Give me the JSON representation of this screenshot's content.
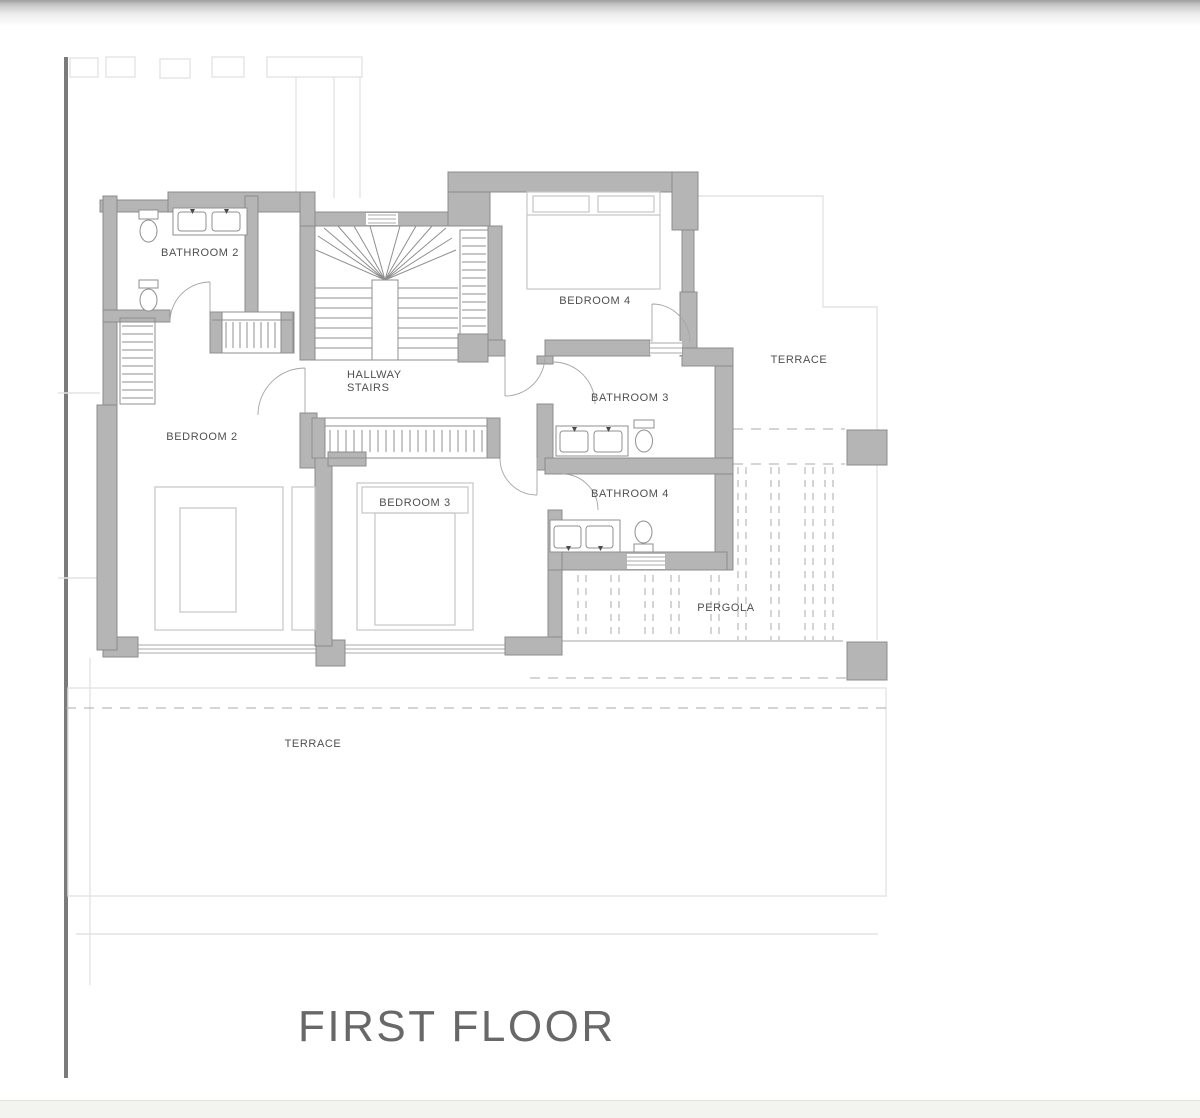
{
  "page": {
    "background": "#ffffff",
    "top_bar_gradient_top": "#9e9e9e",
    "bottom_bar_color": "#f3f3f0",
    "left_divider_color": "#7b7b7b"
  },
  "plan": {
    "title": "FIRST FLOOR",
    "title_color": "#686868",
    "wall_color": "#b5b5b5",
    "wall_edge_color": "#8c8c8c",
    "line_color": "#8f8f8f",
    "furniture_line_color": "#c6c6c6",
    "faint_line_color": "#e3e3e3",
    "dashed_line_color": "#ababab",
    "label_color": "#4f4f4f",
    "labels": [
      {
        "id": "bathroom-2",
        "text": "BATHROOM 2"
      },
      {
        "id": "hallway",
        "text": "HALLWAY"
      },
      {
        "id": "stairs",
        "text": "STAIRS"
      },
      {
        "id": "bedroom-2",
        "text": "BEDROOM 2"
      },
      {
        "id": "bedroom-4",
        "text": "BEDROOM 4"
      },
      {
        "id": "bathroom-3",
        "text": "BATHROOM 3"
      },
      {
        "id": "bathroom-4",
        "text": "BATHROOM 4"
      },
      {
        "id": "bedroom-3",
        "text": "BEDROOM 3"
      },
      {
        "id": "terrace-upper",
        "text": "TERRACE"
      },
      {
        "id": "pergola",
        "text": "PERGOLA"
      },
      {
        "id": "terrace-lower",
        "text": "TERRACE"
      }
    ]
  }
}
